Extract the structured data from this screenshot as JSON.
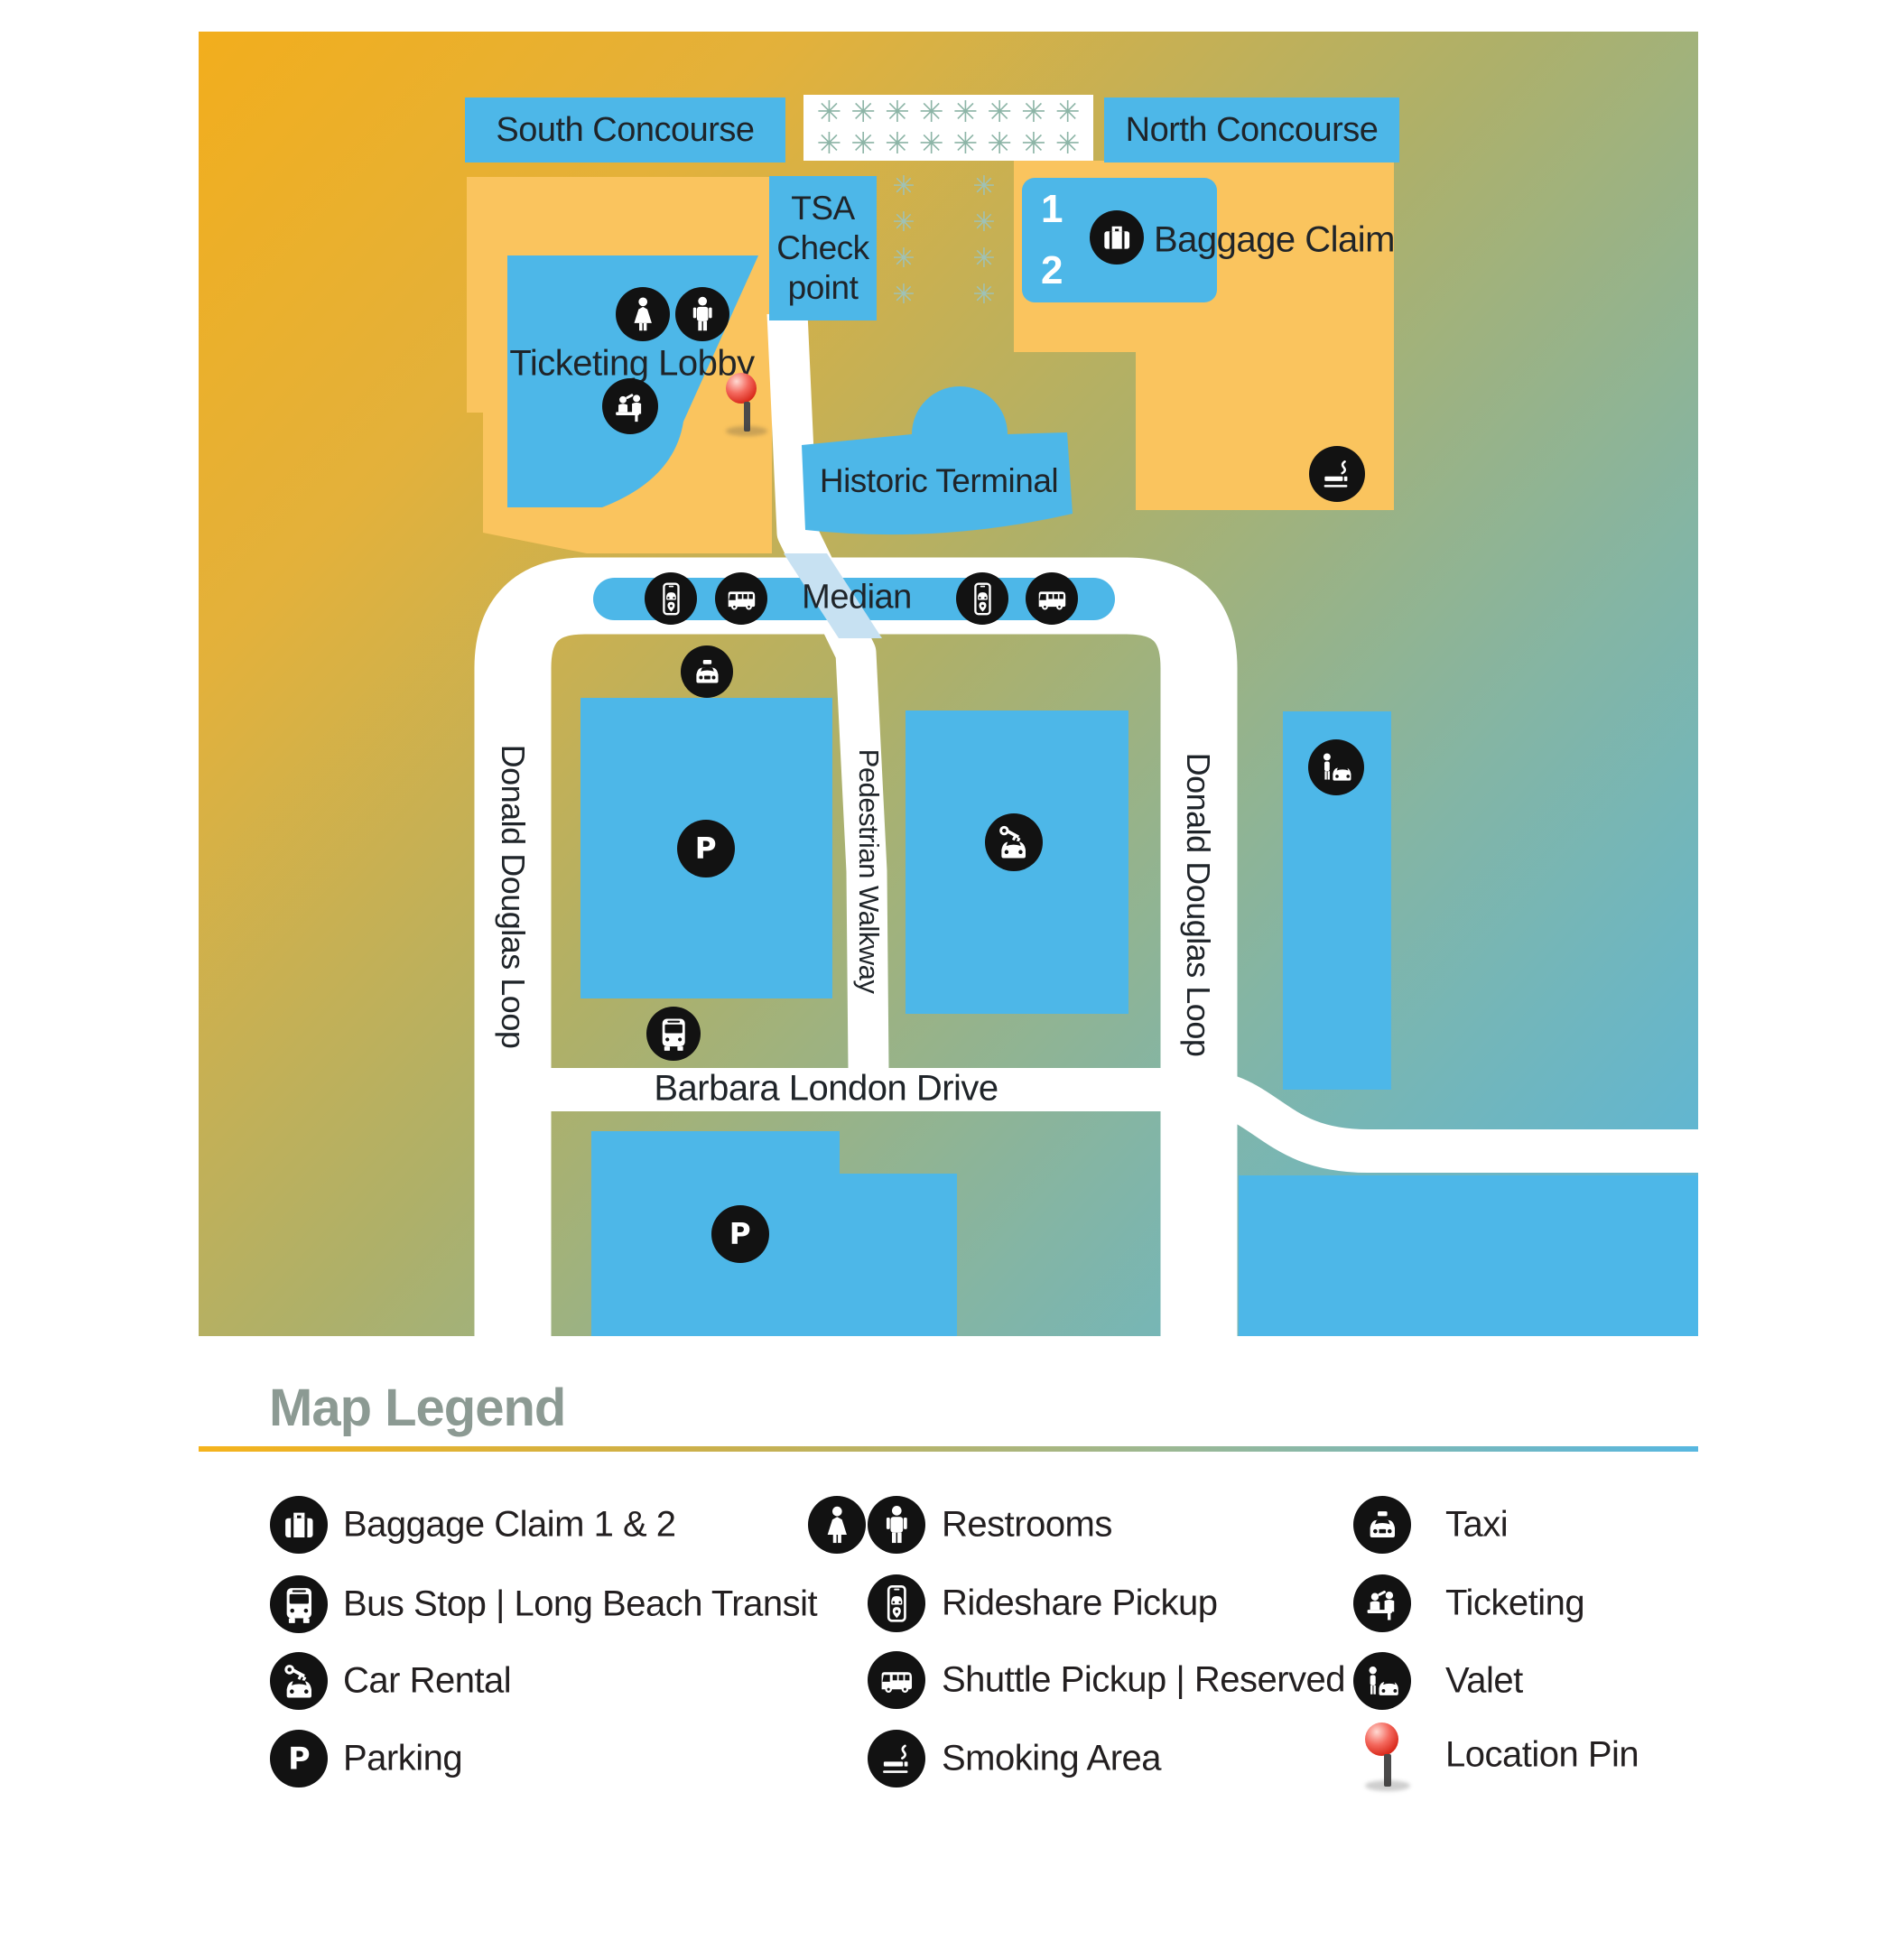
{
  "map": {
    "labels": {
      "south_concourse": "South Concourse",
      "north_concourse": "North Concourse",
      "tsa_line1": "TSA",
      "tsa_line2": "Check",
      "tsa_line3": "point",
      "baggage_claim_label": "Baggage Claim",
      "baggage_carousel_1": "1",
      "baggage_carousel_2": "2",
      "ticketing_lobby": "Ticketing Lobby",
      "historic_terminal": "Historic Terminal",
      "median": "Median",
      "donald_douglas_loop": "Donald Douglas Loop",
      "pedestrian_walkway": "Pedestrian Walkway",
      "barbara_london_drive": "Barbara London Drive"
    },
    "decorations": {
      "asterisk_char": "✳",
      "top_box_rows": 2,
      "top_box_per_row": 8,
      "side_columns": 2,
      "per_column": 4
    },
    "icons_on_map": [
      "restroom-woman-icon",
      "restroom-man-icon",
      "ticketing-icon",
      "location-pin",
      "baggage-icon",
      "smoking-icon",
      "rideshare-icon",
      "shuttle-icon",
      "taxi-icon",
      "parking-icon",
      "car-rental-icon",
      "valet-icon",
      "bus-icon"
    ],
    "colors": {
      "gradient_top_left": "#F2AE1D",
      "gradient_mid": "#AFB068",
      "gradient_bottom_right": "#56B7E0",
      "building_blue": "#4DB7E8",
      "terminal_orange": "#FAC45E",
      "road_white": "#FFFFFF",
      "asterisk_teal": "#8DB5A7",
      "asterisk_teal_light": "#9EC2B8",
      "crosswalk_blue": "#C7E1F2",
      "icon_black": "#121212",
      "map_text": "#1F2429",
      "pin_red": "#E8453C"
    }
  },
  "legend": {
    "title": "Map Legend",
    "heading_color": "#8C9A93",
    "text_color": "#231F20",
    "columns": [
      {
        "items": [
          {
            "icon": "baggage-icon",
            "label": "Baggage Claim 1 & 2"
          },
          {
            "icon": "bus-icon",
            "label": "Bus Stop | Long Beach Transit"
          },
          {
            "icon": "car-rental-icon",
            "label": "Car Rental"
          },
          {
            "icon": "parking-icon",
            "label": "Parking"
          }
        ]
      },
      {
        "items": [
          {
            "icon": "restroom-icons",
            "label": "Restrooms"
          },
          {
            "icon": "rideshare-icon",
            "label": "Rideshare Pickup"
          },
          {
            "icon": "shuttle-icon",
            "label": "Shuttle Pickup | Reserved"
          },
          {
            "icon": "smoking-icon",
            "label": "Smoking Area"
          }
        ]
      },
      {
        "items": [
          {
            "icon": "taxi-icon",
            "label": "Taxi"
          },
          {
            "icon": "ticketing-icon",
            "label": "Ticketing"
          },
          {
            "icon": "valet-icon",
            "label": "Valet"
          },
          {
            "icon": "location-pin",
            "label": "Location Pin"
          }
        ]
      }
    ]
  }
}
